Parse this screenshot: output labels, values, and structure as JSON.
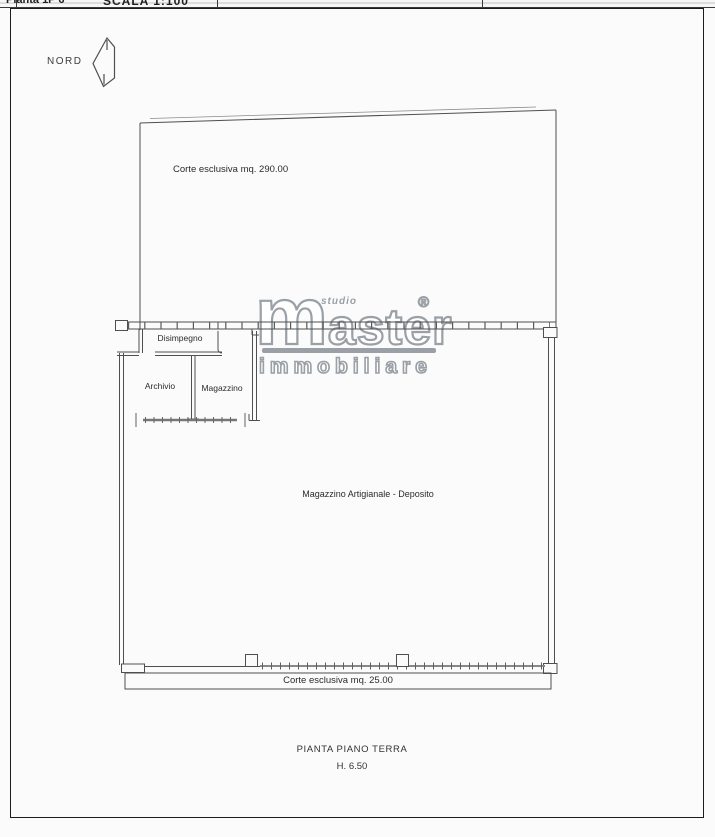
{
  "header": {
    "left_fragment": "Pianta 1P 6",
    "center_fragment": "SCALA 1:100"
  },
  "compass": {
    "label": "NORD"
  },
  "plan": {
    "courtyard_top_label": "Corte esclusiva mq. 290.00",
    "courtyard_bottom_label": "Corte esclusiva mq. 25.00",
    "rooms": {
      "disimpegno": "Disimpegno",
      "archivio": "Archivio",
      "magazzino": "Magazzino",
      "main_hall": "Magazzino Artigianale - Deposito"
    }
  },
  "logo": {
    "studio": "studio",
    "name_m": "m",
    "name_rest": "aster",
    "registered": "®",
    "subtitle": "immobiliare"
  },
  "caption": {
    "title": "PIANTA PIANO TERRA",
    "height": "H. 6.50"
  },
  "colors": {
    "line": "#4f4f4f",
    "logo_gray": "#9aa0a6",
    "page_border": "#1c1c1c"
  }
}
